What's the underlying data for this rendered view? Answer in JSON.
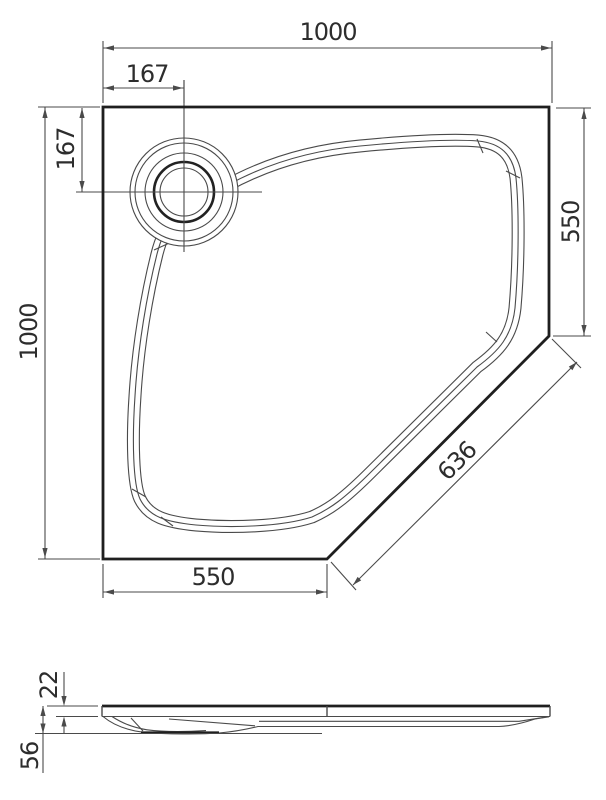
{
  "drawing": {
    "kind": "technical-dimension-drawing",
    "views": {
      "plan": "pentagon shower tray top view",
      "profile": "shower tray side view"
    }
  },
  "dimensions": {
    "width_top": "1000",
    "drain_offset_horizontal": "167",
    "drain_offset_vertical": "167",
    "height_left": "1000",
    "side_right": "550",
    "diagonal_cut": "636",
    "bottom_segment": "550",
    "profile_rim_height": "22",
    "profile_total_height": "56"
  },
  "colors": {
    "background": "#ffffff",
    "line_bold": "#1f1f1f",
    "line_thin": "#4a4a4a",
    "text": "#2d2d2d"
  }
}
